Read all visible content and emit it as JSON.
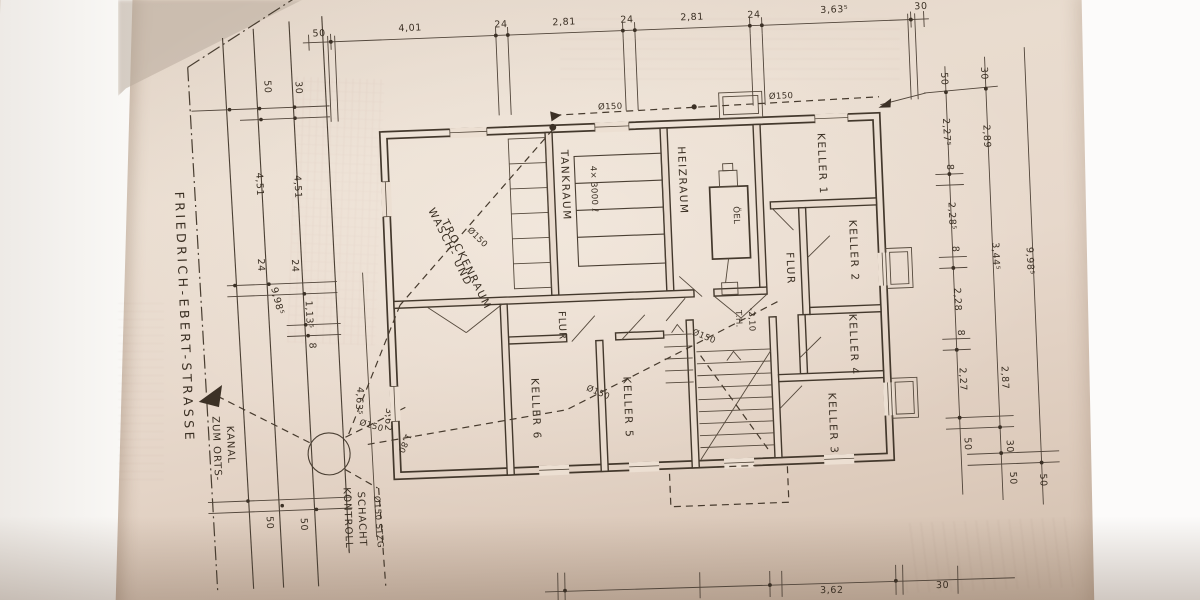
{
  "document": {
    "kind": "Photographed hand-drafted basement floor plan (Kellergeschoss)",
    "street": {
      "name": "FRIEDRICH-EBERT-STRASSE"
    },
    "sewer": {
      "arrow_line1": "ZUM ORTS-",
      "arrow_line2": "KANAL",
      "shaft_line1": "KONTROLL-",
      "shaft_line2": "SCHACHT",
      "pipe_label": "Ø150 STZG",
      "dia": "Ø150"
    },
    "rooms": {
      "wasch_line1": "WASCH- UND",
      "wasch_line2": "TROCKENRAUM",
      "tankraum": "TANKRAUM",
      "tank_capacity": "4× 3000 ℓ",
      "heizraum": "HEIZRAUM",
      "oel": "ÖEL",
      "flur": "FLUR",
      "keller1": "KELLER 1",
      "keller2": "KELLER 2",
      "keller3": "KELLER 3",
      "keller4": "KELLER 4",
      "keller5": "KELLER 5",
      "keller6": "KELLER 6",
      "th": "T.H.",
      "th_value": "-2,10"
    },
    "dims": {
      "top": [
        "50",
        "4,01",
        "24",
        "2,81",
        "24",
        "2,81",
        "24",
        "3,63⁵",
        "30"
      ],
      "left": {
        "d50": "50",
        "d30": "30",
        "d451": "4,51",
        "d24": "24",
        "d1135": "1,13⁵",
        "d8": "8",
        "d9985": "9,98⁵",
        "d4635": "4,63⁵",
        "d362": "3,62",
        "d180": "1,80"
      },
      "right_inner": [
        "50",
        "2,27⁵",
        "8",
        "2,28⁵",
        "8",
        "2,28",
        "8",
        "2,27",
        "50"
      ],
      "right_mid": [
        "30",
        "2,89",
        "3,44⁵",
        "2,87",
        "30"
      ],
      "right_outer": "9,98⁵",
      "bottom": [
        "3,62",
        "30"
      ]
    }
  }
}
